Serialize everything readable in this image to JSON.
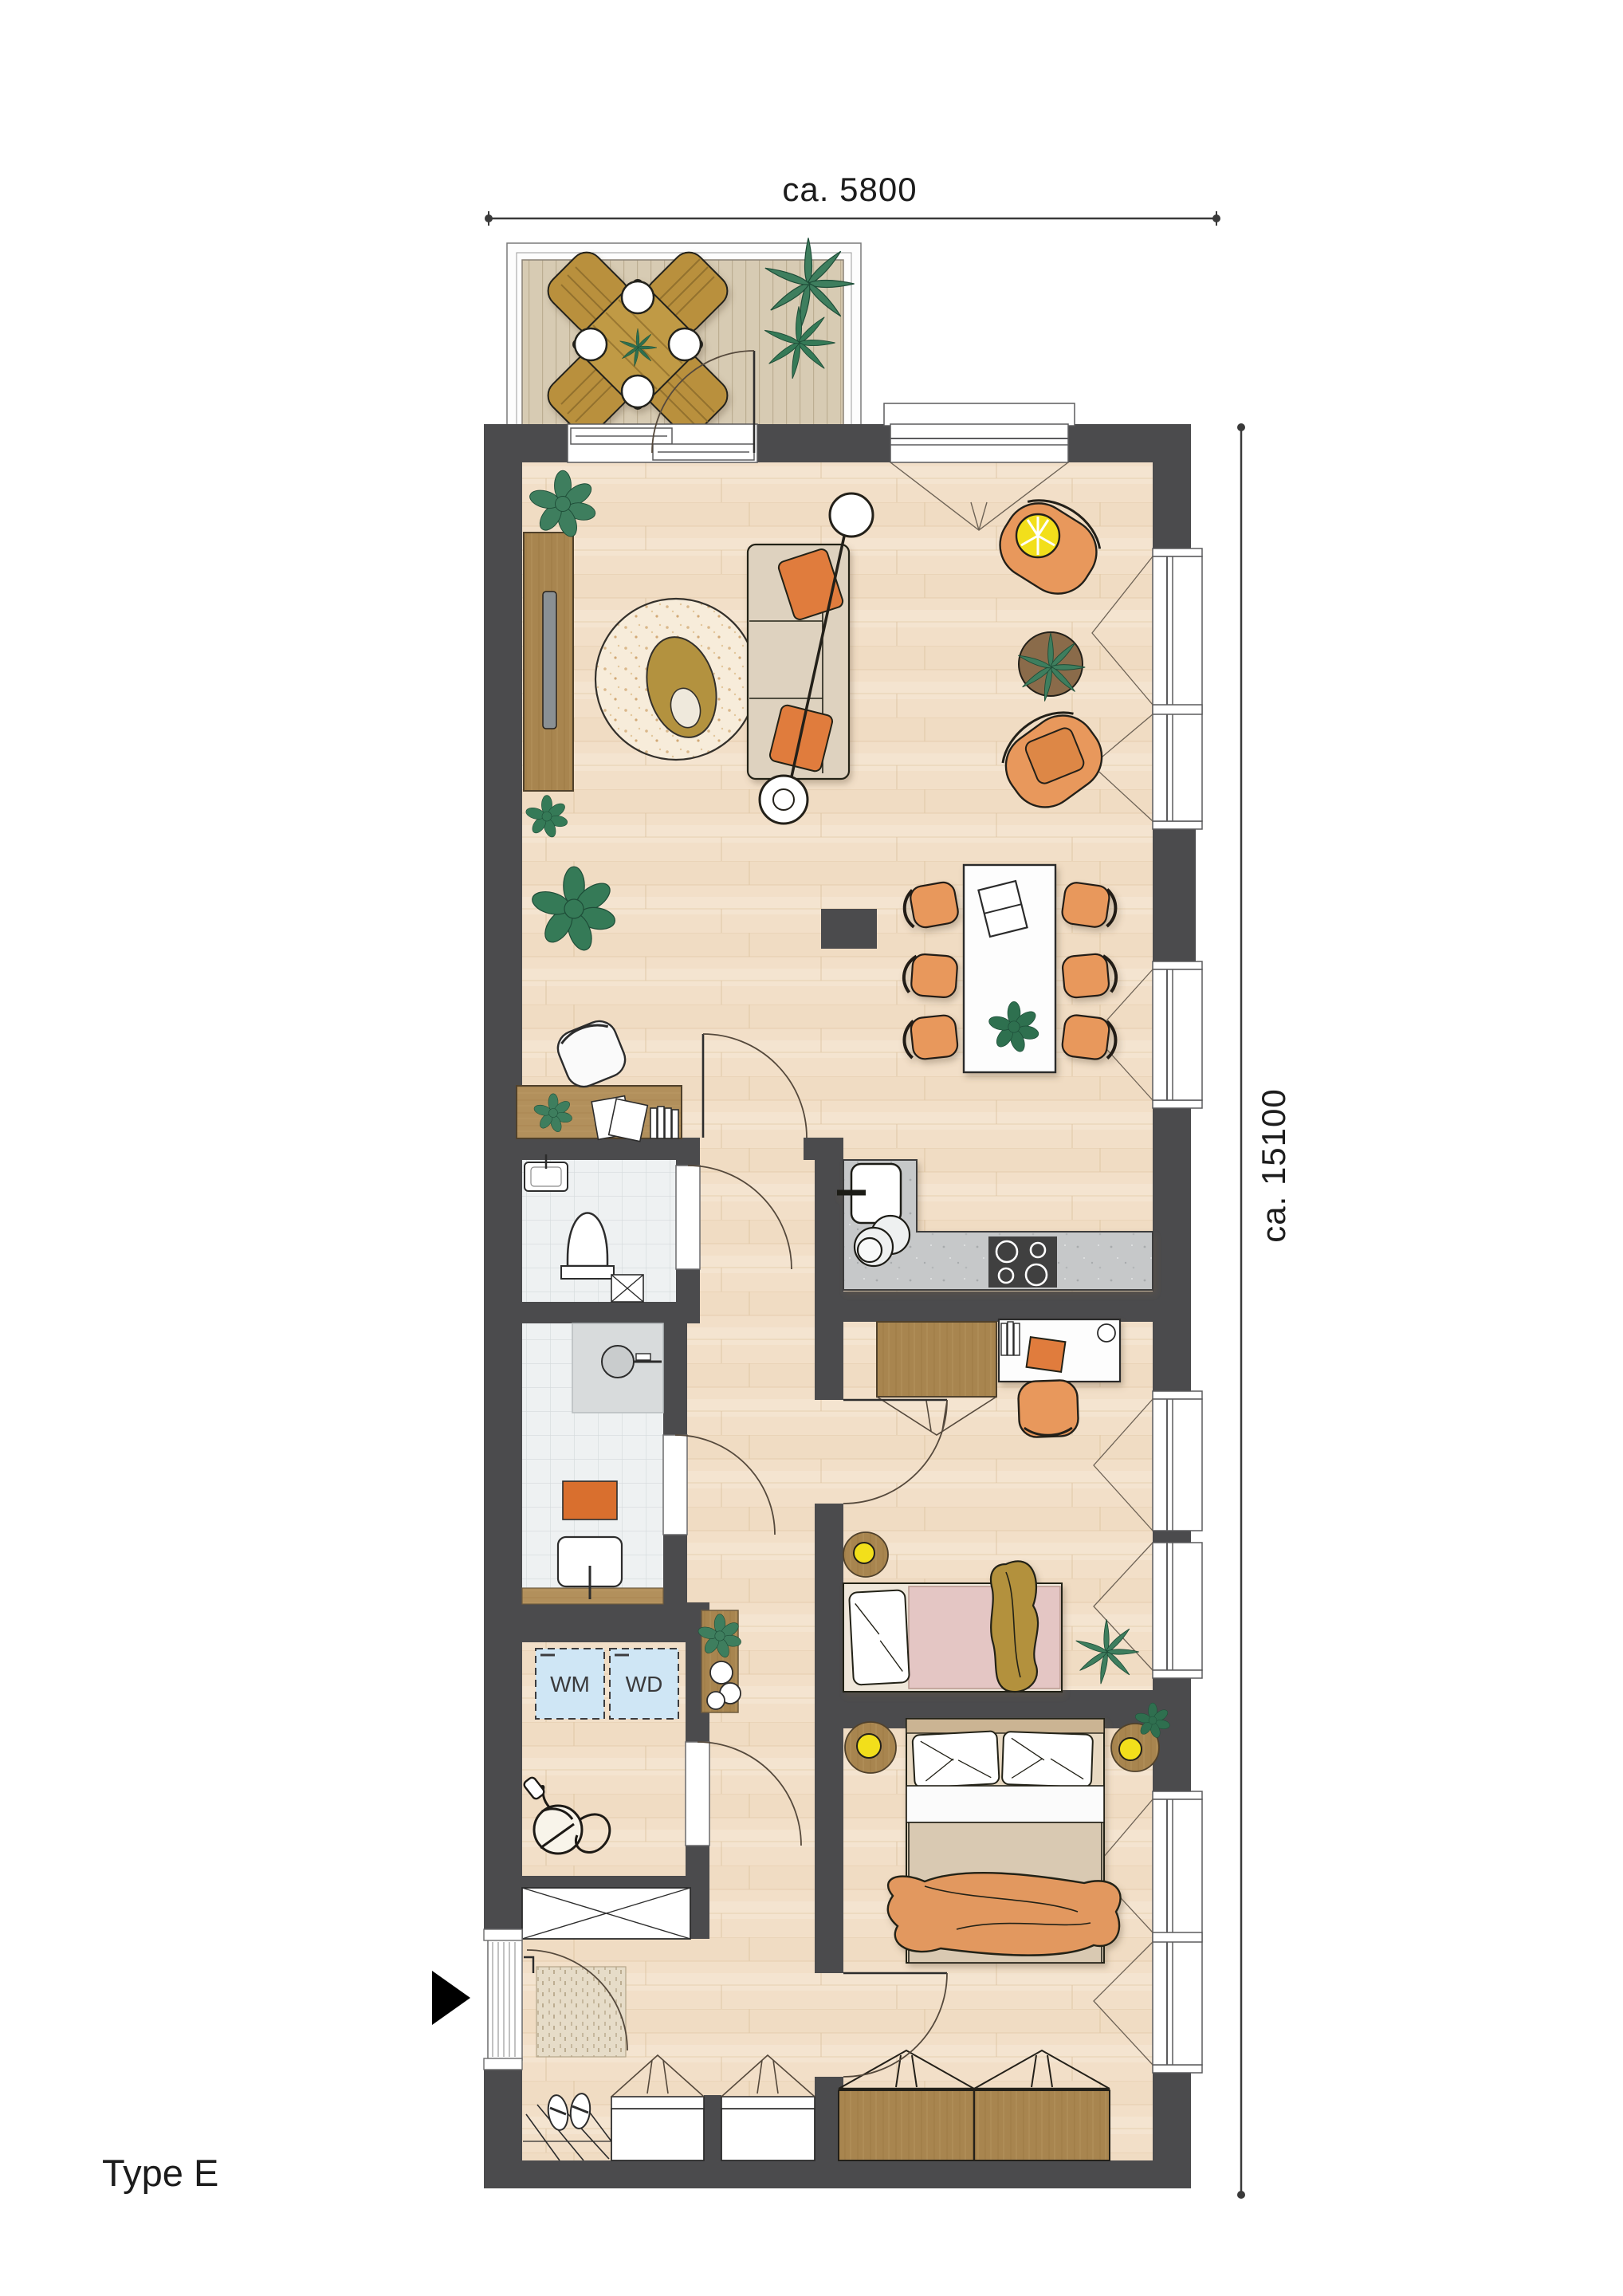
{
  "dimensions": {
    "width_label": "ca. 5800",
    "height_label": "ca. 15100"
  },
  "title": {
    "plan_type": "Type E"
  },
  "utility": {
    "washer_label": "WM",
    "dryer_label": "WD"
  },
  "colors": {
    "wall": "#4b4b4d",
    "floor_wood": "#f2dfc8",
    "balcony_deck": "#d7cbb3",
    "tile": "#eef1f2",
    "counter": "#c6c8c9",
    "accent_orange": "#e8985c",
    "pillow_orange": "#e07c3c",
    "lamp_yellow": "#f2df1b",
    "plant_green": "#3e7e5e",
    "wood_furniture": "#b2905c",
    "wardrobe_brown": "#a8854f",
    "appliance_blue": "#cfe6f5",
    "bed_pink": "#e4c6c4",
    "blanket_gold": "#b3913c",
    "duvet_beige": "#d9c9b2"
  }
}
